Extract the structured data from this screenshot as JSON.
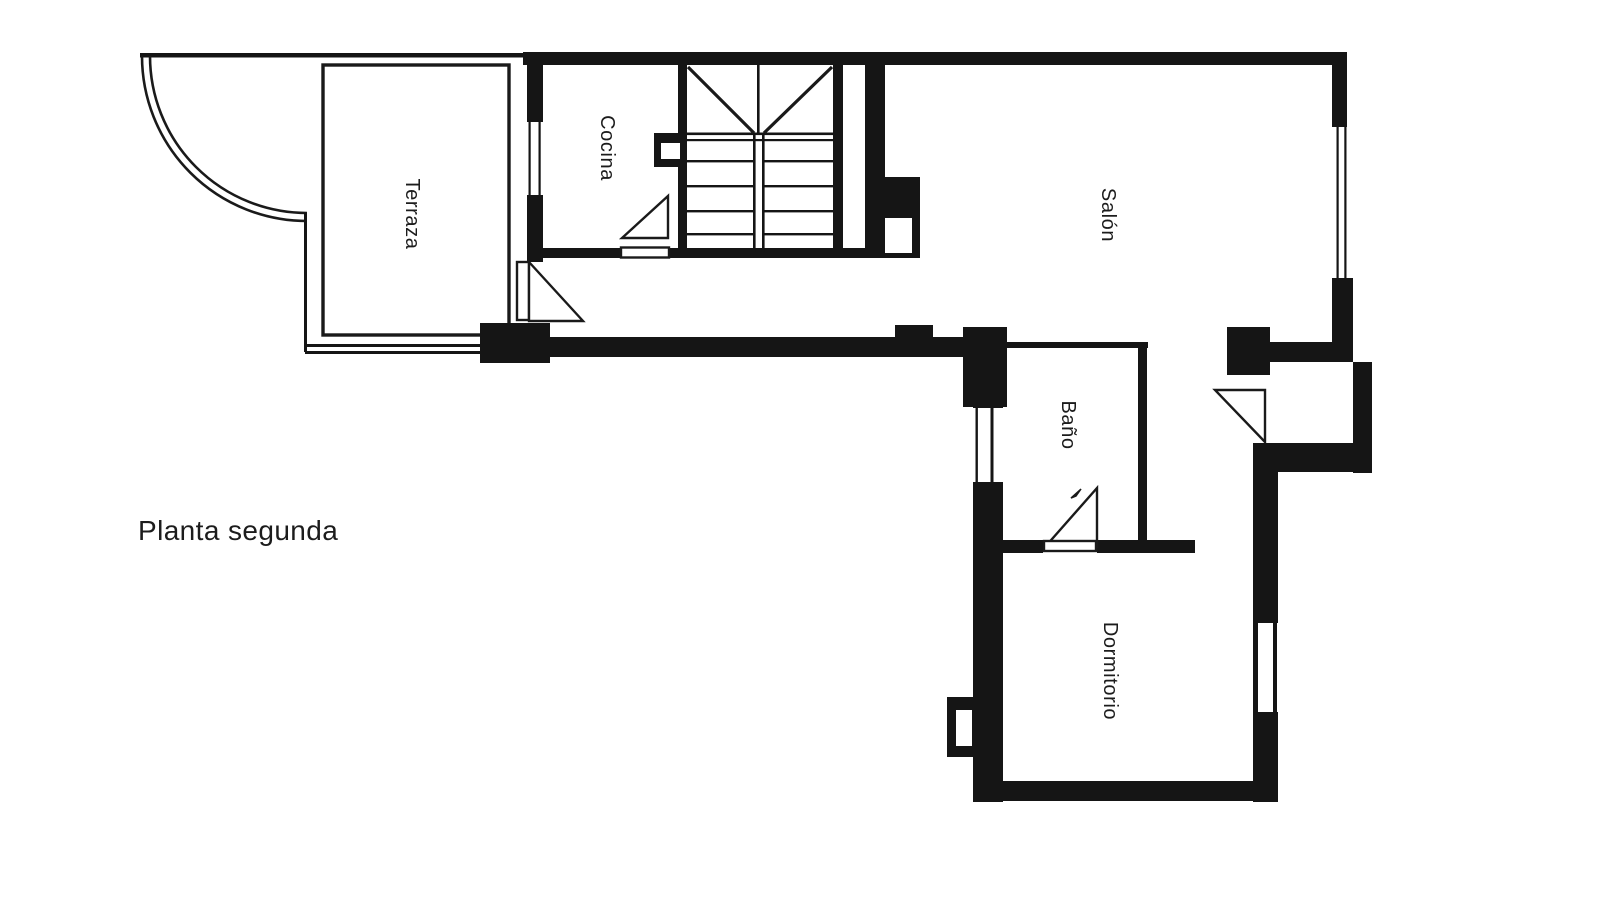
{
  "plan": {
    "title": "Planta segunda"
  },
  "colors": {
    "background": "#ffffff",
    "wall": "#151515",
    "line": "#1a1a1a",
    "text": "#1c1c1c"
  },
  "rooms": {
    "terraza": {
      "label": "Terraza"
    },
    "cocina": {
      "label": "Cocina"
    },
    "salon": {
      "label": "Salón"
    },
    "bano": {
      "label": "Baño"
    },
    "dormitorio": {
      "label": "Dormitorio"
    }
  }
}
